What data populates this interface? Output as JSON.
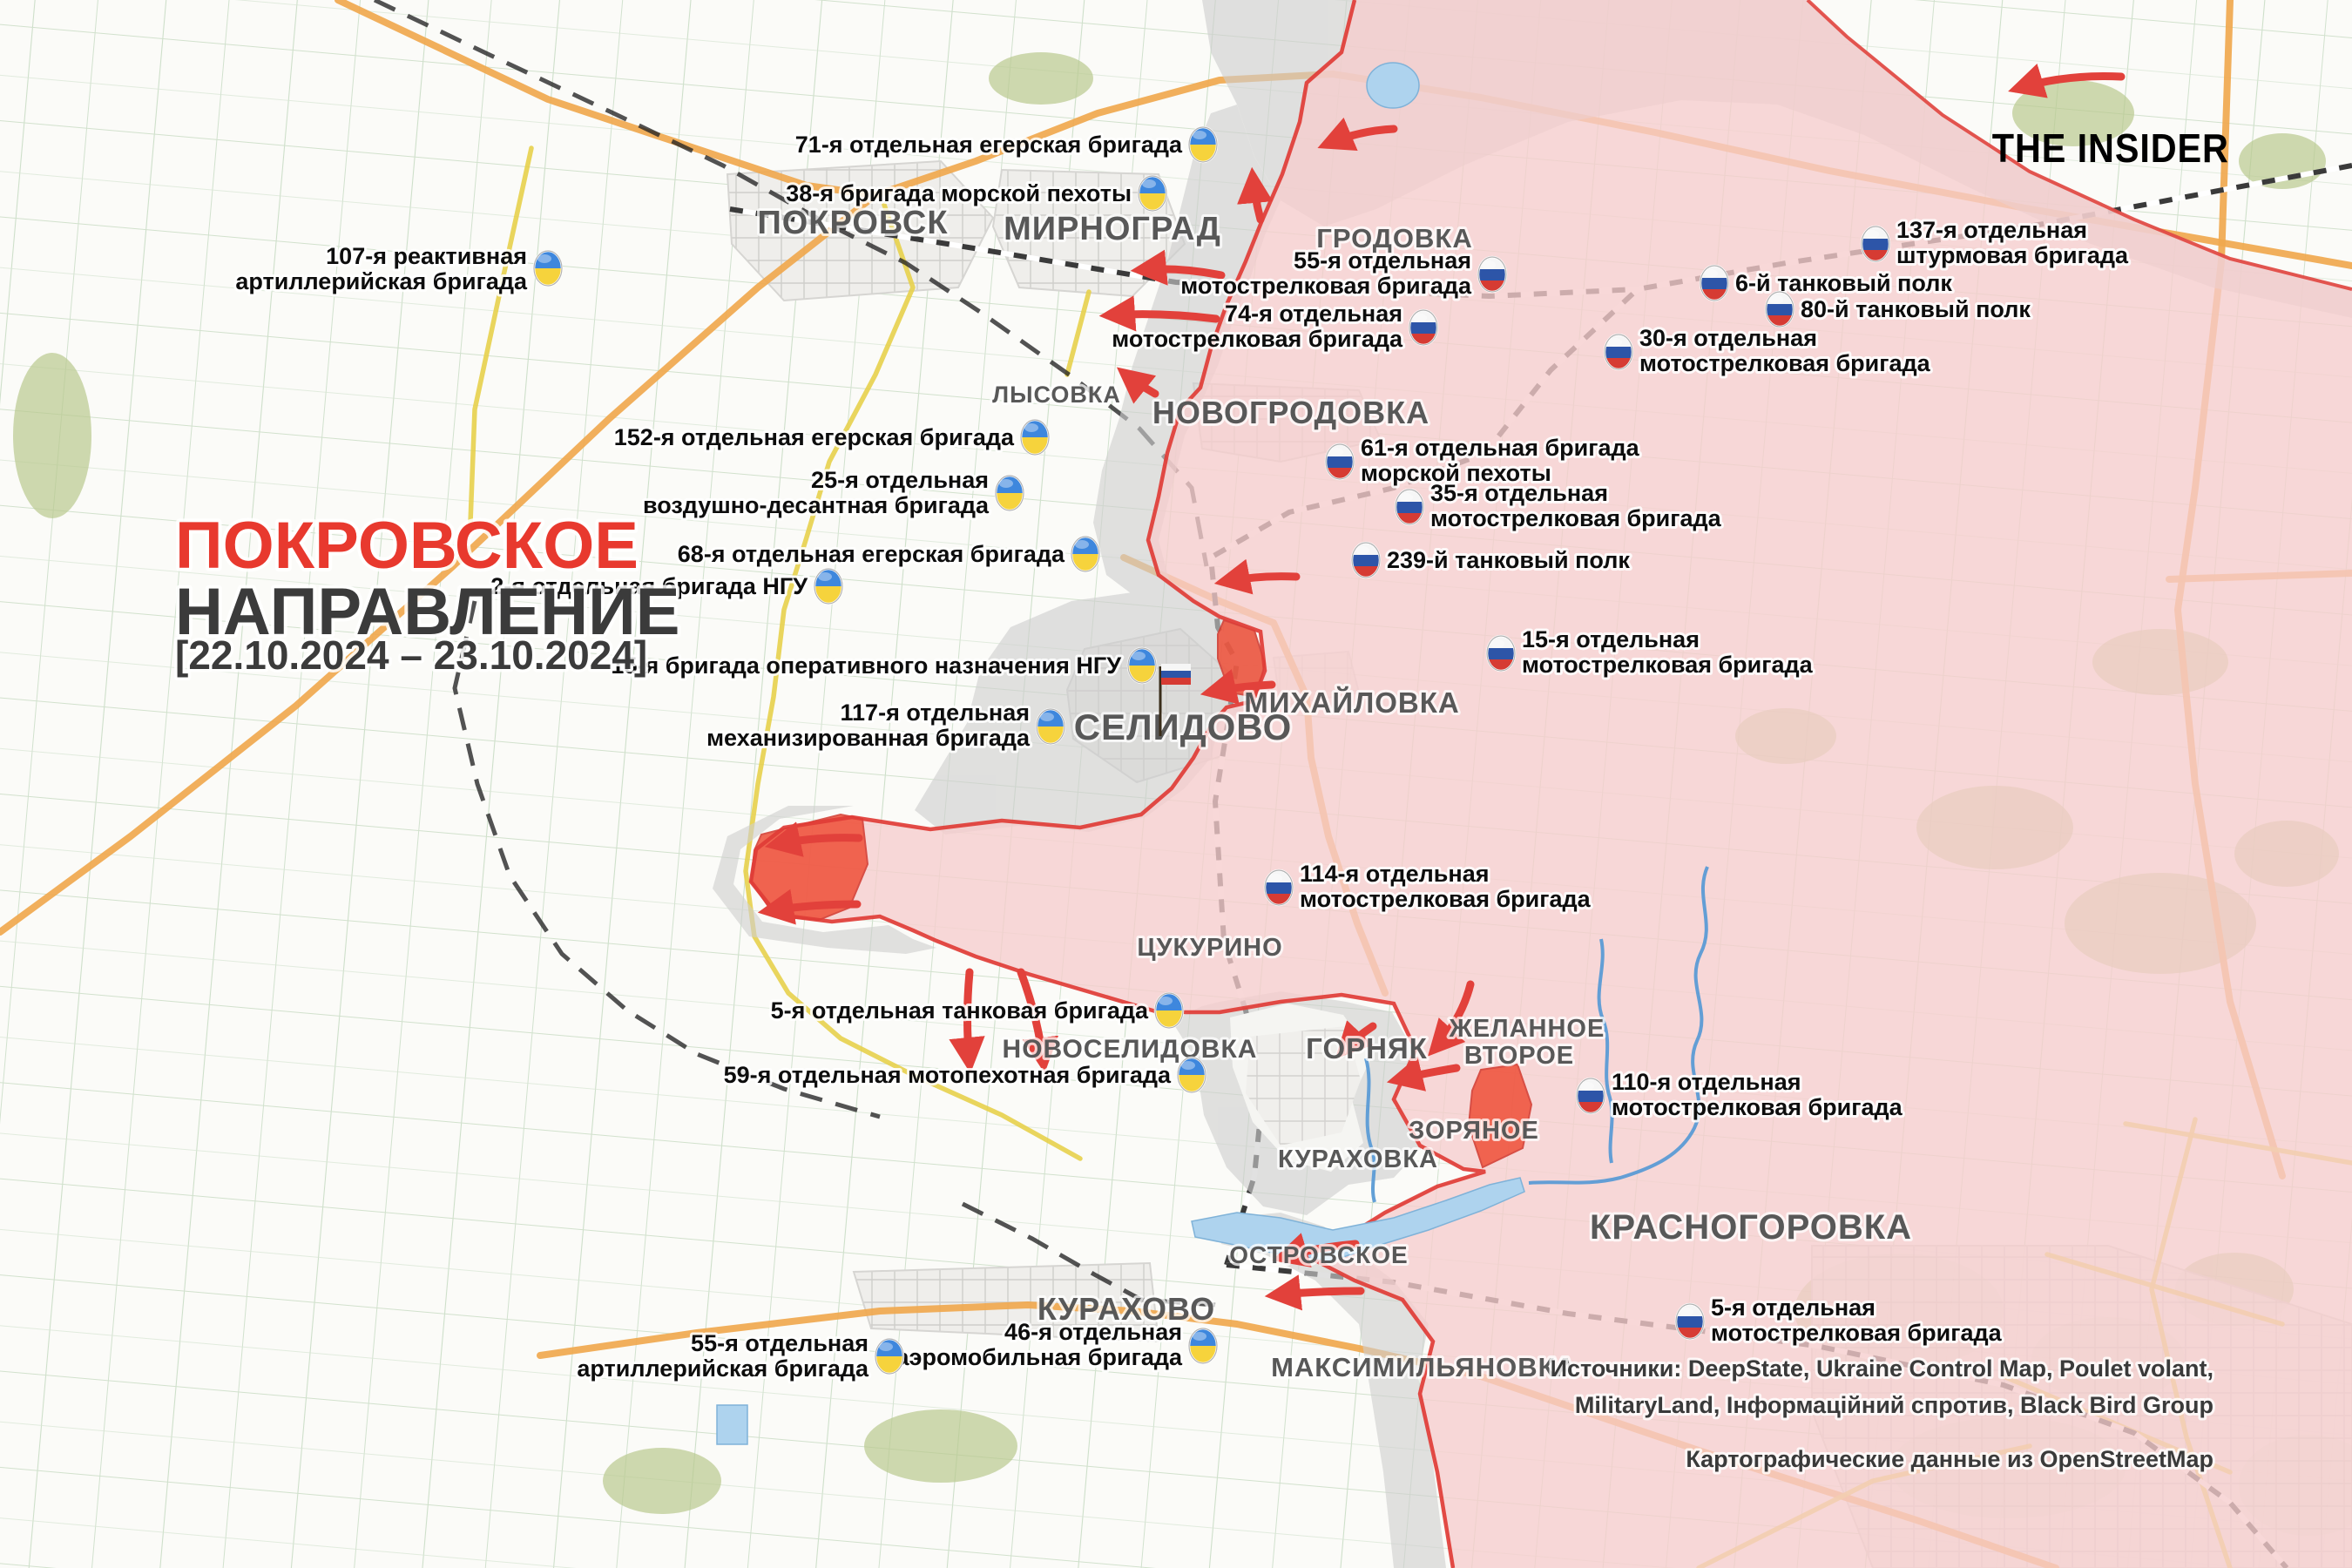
{
  "branding": {
    "logo_text": "THE INSIDER"
  },
  "title": {
    "line1": "ПОКРОВСКОЕ",
    "line2": "НАПРАВЛЕНИЕ",
    "date_range": "[22.10.2024 – 23.10.2024]"
  },
  "sources": {
    "line1": "Источники: DeepState, Ukraine Control Map, Poulet volant,",
    "line2": "MilitaryLand, Інформаційний спротив, Black Bird Group",
    "line3": "Картографические данные из OpenStreetMap"
  },
  "cities": {
    "pokrovsk": "ПОКРОВСК",
    "mirnograd": "МИРНОГРАД",
    "grodovka": "ГРОДОВКА",
    "lysovka": "ЛЫСОВКА",
    "novogrodovka": "НОВОГРОДОВКА",
    "mikhaylovka": "МИХАЙЛОВКА",
    "selidovo": "СЕЛИДОВО",
    "tsukurino": "ЦУКУРИНО",
    "novoselidovka": "НОВОСЕЛИДОВКА",
    "gornyak": "ГОРНЯК",
    "zhelannoye_1": "ЖЕЛАННОЕ",
    "zhelannoye_2": "ВТОРОЕ",
    "zoryanoye": "ЗОРЯНОЕ",
    "kurakhovka": "КУРАХОВКА",
    "krasnogorovka": "КРАСНОГОРОВКА",
    "ostrovskoye": "ОСТРОВСКОЕ",
    "kurakhovo": "КУРАХОВО",
    "maksimilyanovka": "МАКСИМИЛЬЯНОВКА"
  },
  "units": {
    "u71": {
      "line1": "71-я отдельная егерская бригада",
      "country": "ua"
    },
    "u38": {
      "line1": "38-я бригада морской пехоты",
      "country": "ua"
    },
    "u107": {
      "line1": "107-я реактивная",
      "line2": "артиллерийская бригада",
      "country": "ua"
    },
    "u152": {
      "line1": "152-я отдельная егерская бригада",
      "country": "ua"
    },
    "u25": {
      "line1": "25-я отдельная",
      "line2": "воздушно-десантная бригада",
      "country": "ua"
    },
    "u68": {
      "line1": "68-я отдельная егерская бригада",
      "country": "ua"
    },
    "u2ngu": {
      "line1": "2-я отдельная бригада НГУ",
      "country": "ua"
    },
    "u15ngu": {
      "line1": "15-я бригада оперативного назначения НГУ",
      "country": "ua"
    },
    "u117": {
      "line1": "117-я отдельная",
      "line2": "механизированная бригада",
      "country": "ua"
    },
    "u5tank": {
      "line1": "5-я отдельная танковая бригада",
      "country": "ua"
    },
    "u59": {
      "line1": "59-я отдельная мотопехотная бригада",
      "country": "ua"
    },
    "u46": {
      "line1": "46-я отдельная",
      "line2": "аэромобильная бригада",
      "country": "ua"
    },
    "u55art": {
      "line1": "55-я отдельная",
      "line2": "артиллерийская бригада",
      "country": "ua"
    },
    "r55": {
      "line1": "55-я отдельная",
      "line2": "мотострелковая бригада",
      "country": "ru"
    },
    "r74": {
      "line1": "74-я отдельная",
      "line2": "мотострелковая бригада",
      "country": "ru"
    },
    "r137": {
      "line1": "137-я отдельная",
      "line2": "штурмовая бригада",
      "country": "ru"
    },
    "r6": {
      "line1": "6-й танковый полк",
      "country": "ru"
    },
    "r80": {
      "line1": "80-й танковый полк",
      "country": "ru"
    },
    "r30": {
      "line1": "30-я отдельная",
      "line2": "мотострелковая бригада",
      "country": "ru"
    },
    "r61": {
      "line1": "61-я отдельная бригада",
      "line2": "морской пехоты",
      "country": "ru"
    },
    "r35": {
      "line1": "35-я отдельная",
      "line2": "мотострелковая бригада",
      "country": "ru"
    },
    "r239": {
      "line1": "239-й танковый полк",
      "country": "ru"
    },
    "r15": {
      "line1": "15-я отдельная",
      "line2": "мотострелковая бригада",
      "country": "ru"
    },
    "r114": {
      "line1": "114-я отдельная",
      "line2": "мотострелковая бригада",
      "country": "ru"
    },
    "r110": {
      "line1": "110-я отдельная",
      "line2": "мотострелковая бригада",
      "country": "ru"
    },
    "r5": {
      "line1": "5-я отдельная",
      "line2": "мотострелковая бригада",
      "country": "ru"
    }
  },
  "legend_colors": {
    "title_accent": "#e8392e",
    "ru_controlled_fill": "#f6cdcd",
    "contested_fill": "#cfcfcf",
    "recent_advance_fill": "#ef4f38",
    "frontline": "#e03c36",
    "attack_arrow": "#e2413b",
    "ua_flag_blue": "#3e87dd",
    "ua_flag_yellow": "#f6d33c",
    "ru_flag_blue": "#2d55a8",
    "ru_flag_red": "#d63b33"
  }
}
